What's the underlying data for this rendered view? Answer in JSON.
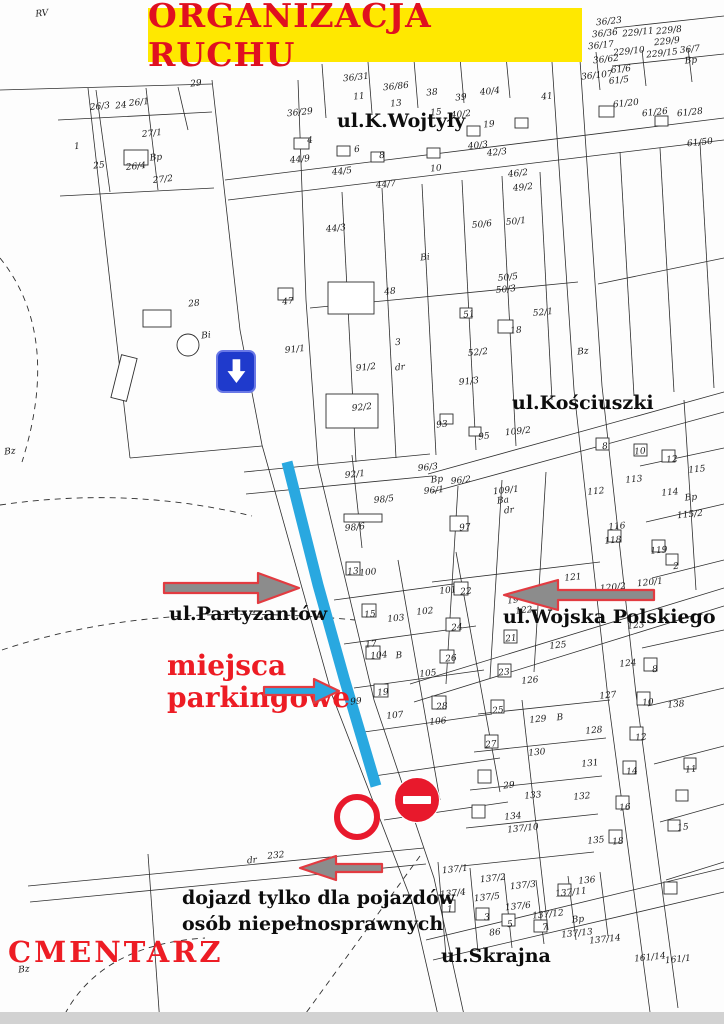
{
  "title": {
    "text": "ORGANIZACJA RUCHU"
  },
  "colors": {
    "banner-bg": "#FFE800",
    "banner-text": "#E01020",
    "annotation-red": "#ED1C24",
    "parking-blue": "#29A8E0",
    "sign-blue": "#1F3ACC",
    "prohibit-red": "#E8192C",
    "arrow-gray": "#8C8C8C",
    "arrow-outline": "#E23B41",
    "map-line": "#2E2E2E"
  },
  "streets": [
    {
      "label": "ul.K.Wojtyły"
    },
    {
      "label": "ul.Kościuszki"
    },
    {
      "label": "ul.Partyzantów"
    },
    {
      "label": "ul.Wojska Polskiego"
    },
    {
      "label": "ul.Skrajna"
    }
  ],
  "annotations": {
    "parking_line1": "miejsca",
    "parking_line2": "parkingowe",
    "cemetery": "CMENTARZ",
    "access_line1": "dojazd tylko dla pojazdów",
    "access_line2": "osób niepełnosprawnych"
  },
  "signs": [
    {
      "name": "one-way-down-sign",
      "glyph": "white-down-arrow-on-blue-square"
    },
    {
      "name": "no-entry-sign",
      "glyph": "white-bar-on-red-circle"
    },
    {
      "name": "prohibition-sign",
      "glyph": "red-circle-outline"
    }
  ],
  "arrows": [
    {
      "name": "direction-arrow-partyzantow",
      "direction": "right",
      "color": "gray"
    },
    {
      "name": "parking-direction-arrow",
      "direction": "right",
      "color": "blue"
    },
    {
      "name": "direction-arrow-wojska-polskiego",
      "direction": "left",
      "color": "gray"
    },
    {
      "name": "disabled-access-arrow",
      "direction": "left",
      "color": "gray"
    }
  ],
  "parcels": [
    {
      "t": "RV",
      "x": 42,
      "y": 14
    },
    {
      "t": "29",
      "x": 196,
      "y": 84
    },
    {
      "t": "26/3",
      "x": 100,
      "y": 107
    },
    {
      "t": "24",
      "x": 121,
      "y": 106
    },
    {
      "t": "26/1",
      "x": 139,
      "y": 103
    },
    {
      "t": "27/1",
      "x": 152,
      "y": 134
    },
    {
      "t": "1",
      "x": 77,
      "y": 147
    },
    {
      "t": "25",
      "x": 99,
      "y": 166
    },
    {
      "t": "26/4",
      "x": 136,
      "y": 167
    },
    {
      "t": "Bp",
      "x": 156,
      "y": 158
    },
    {
      "t": "27/2",
      "x": 163,
      "y": 180
    },
    {
      "t": "28",
      "x": 194,
      "y": 304
    },
    {
      "t": "Bi",
      "x": 206,
      "y": 336
    },
    {
      "t": "Bz",
      "x": 10,
      "y": 452
    },
    {
      "t": "Bz",
      "x": 24,
      "y": 970
    },
    {
      "t": "36/29",
      "x": 300,
      "y": 113
    },
    {
      "t": "4",
      "x": 310,
      "y": 141
    },
    {
      "t": "44/9",
      "x": 300,
      "y": 160
    },
    {
      "t": "6",
      "x": 357,
      "y": 150
    },
    {
      "t": "8",
      "x": 382,
      "y": 156
    },
    {
      "t": "10",
      "x": 436,
      "y": 169
    },
    {
      "t": "13",
      "x": 396,
      "y": 104
    },
    {
      "t": "11",
      "x": 359,
      "y": 97
    },
    {
      "t": "36/31",
      "x": 356,
      "y": 78
    },
    {
      "t": "36/86",
      "x": 396,
      "y": 87
    },
    {
      "t": "38",
      "x": 432,
      "y": 93
    },
    {
      "t": "39",
      "x": 461,
      "y": 98
    },
    {
      "t": "15",
      "x": 436,
      "y": 113
    },
    {
      "t": "40/4",
      "x": 490,
      "y": 92
    },
    {
      "t": "40/2",
      "x": 461,
      "y": 115
    },
    {
      "t": "19",
      "x": 489,
      "y": 125
    },
    {
      "t": "40/3",
      "x": 478,
      "y": 146
    },
    {
      "t": "42/3",
      "x": 497,
      "y": 153
    },
    {
      "t": "41",
      "x": 547,
      "y": 97
    },
    {
      "t": "44/5",
      "x": 342,
      "y": 172
    },
    {
      "t": "44/7",
      "x": 386,
      "y": 185
    },
    {
      "t": "44/3",
      "x": 336,
      "y": 229
    },
    {
      "t": "46/2",
      "x": 518,
      "y": 174
    },
    {
      "t": "49/2",
      "x": 523,
      "y": 188
    },
    {
      "t": "Bi",
      "x": 425,
      "y": 258
    },
    {
      "t": "47",
      "x": 288,
      "y": 302
    },
    {
      "t": "48",
      "x": 390,
      "y": 292
    },
    {
      "t": "3",
      "x": 398,
      "y": 343
    },
    {
      "t": "91/1",
      "x": 295,
      "y": 350
    },
    {
      "t": "50/6",
      "x": 482,
      "y": 225
    },
    {
      "t": "50/1",
      "x": 516,
      "y": 222
    },
    {
      "t": "50/5",
      "x": 508,
      "y": 278
    },
    {
      "t": "50/3",
      "x": 506,
      "y": 290
    },
    {
      "t": "51",
      "x": 469,
      "y": 315
    },
    {
      "t": "18",
      "x": 516,
      "y": 331
    },
    {
      "t": "52/1",
      "x": 543,
      "y": 313
    },
    {
      "t": "52/2",
      "x": 478,
      "y": 353
    },
    {
      "t": "91/2",
      "x": 366,
      "y": 368
    },
    {
      "t": "dr",
      "x": 400,
      "y": 368
    },
    {
      "t": "91/3",
      "x": 469,
      "y": 382
    },
    {
      "t": "92/2",
      "x": 362,
      "y": 408
    },
    {
      "t": "93",
      "x": 442,
      "y": 425
    },
    {
      "t": "95",
      "x": 484,
      "y": 437
    },
    {
      "t": "96/3",
      "x": 428,
      "y": 468
    },
    {
      "t": "Bp",
      "x": 437,
      "y": 480
    },
    {
      "t": "96/2",
      "x": 461,
      "y": 481
    },
    {
      "t": "96/1",
      "x": 434,
      "y": 491
    },
    {
      "t": "92/1",
      "x": 355,
      "y": 475
    },
    {
      "t": "98/5",
      "x": 384,
      "y": 500
    },
    {
      "t": "98/6",
      "x": 355,
      "y": 528
    },
    {
      "t": "97",
      "x": 465,
      "y": 528
    },
    {
      "t": "109/1",
      "x": 506,
      "y": 491
    },
    {
      "t": "Ba",
      "x": 503,
      "y": 501
    },
    {
      "t": "dr",
      "x": 509,
      "y": 511
    },
    {
      "t": "109/2",
      "x": 518,
      "y": 432
    },
    {
      "t": "Bz",
      "x": 583,
      "y": 352
    },
    {
      "t": "36/23",
      "x": 609,
      "y": 22
    },
    {
      "t": "36/36",
      "x": 605,
      "y": 34
    },
    {
      "t": "36/17",
      "x": 601,
      "y": 46
    },
    {
      "t": "36/62",
      "x": 606,
      "y": 60
    },
    {
      "t": "36/107",
      "x": 597,
      "y": 76
    },
    {
      "t": "229/11",
      "x": 638,
      "y": 33
    },
    {
      "t": "229/8",
      "x": 669,
      "y": 31
    },
    {
      "t": "229/9",
      "x": 667,
      "y": 42
    },
    {
      "t": "229/10",
      "x": 629,
      "y": 52
    },
    {
      "t": "229/15",
      "x": 662,
      "y": 54
    },
    {
      "t": "36/7",
      "x": 690,
      "y": 50
    },
    {
      "t": "Bp",
      "x": 691,
      "y": 61
    },
    {
      "t": "61/6",
      "x": 621,
      "y": 70
    },
    {
      "t": "61/5",
      "x": 619,
      "y": 81
    },
    {
      "t": "61/20",
      "x": 626,
      "y": 104
    },
    {
      "t": "61/26",
      "x": 655,
      "y": 113
    },
    {
      "t": "61/28",
      "x": 690,
      "y": 113
    },
    {
      "t": "61/50",
      "x": 700,
      "y": 143
    },
    {
      "t": "8",
      "x": 605,
      "y": 447
    },
    {
      "t": "10",
      "x": 640,
      "y": 452
    },
    {
      "t": "12",
      "x": 672,
      "y": 460
    },
    {
      "t": "112",
      "x": 596,
      "y": 492
    },
    {
      "t": "113",
      "x": 634,
      "y": 480
    },
    {
      "t": "114",
      "x": 670,
      "y": 493
    },
    {
      "t": "115",
      "x": 697,
      "y": 470
    },
    {
      "t": "Bp",
      "x": 691,
      "y": 498
    },
    {
      "t": "115/2",
      "x": 690,
      "y": 515
    },
    {
      "t": "116",
      "x": 617,
      "y": 527
    },
    {
      "t": "118",
      "x": 613,
      "y": 541
    },
    {
      "t": "119",
      "x": 659,
      "y": 551
    },
    {
      "t": "2",
      "x": 676,
      "y": 567
    },
    {
      "t": "120/1",
      "x": 650,
      "y": 583
    },
    {
      "t": "120/2",
      "x": 613,
      "y": 588
    },
    {
      "t": "121",
      "x": 573,
      "y": 578
    },
    {
      "t": "122",
      "x": 524,
      "y": 611
    },
    {
      "t": "19",
      "x": 513,
      "y": 601
    },
    {
      "t": "123",
      "x": 636,
      "y": 626
    },
    {
      "t": "124",
      "x": 628,
      "y": 664
    },
    {
      "t": "125",
      "x": 558,
      "y": 646
    },
    {
      "t": "21",
      "x": 511,
      "y": 639
    },
    {
      "t": "126",
      "x": 530,
      "y": 681
    },
    {
      "t": "23",
      "x": 504,
      "y": 673
    },
    {
      "t": "127",
      "x": 608,
      "y": 696
    },
    {
      "t": "129",
      "x": 538,
      "y": 720
    },
    {
      "t": "25",
      "x": 498,
      "y": 711
    },
    {
      "t": "B",
      "x": 560,
      "y": 718
    },
    {
      "t": "128",
      "x": 594,
      "y": 731
    },
    {
      "t": "130",
      "x": 537,
      "y": 753
    },
    {
      "t": "27",
      "x": 491,
      "y": 745
    },
    {
      "t": "131",
      "x": 590,
      "y": 764
    },
    {
      "t": "133",
      "x": 533,
      "y": 796
    },
    {
      "t": "29",
      "x": 509,
      "y": 786
    },
    {
      "t": "132",
      "x": 582,
      "y": 797
    },
    {
      "t": "134",
      "x": 513,
      "y": 817
    },
    {
      "t": "137/10",
      "x": 523,
      "y": 829
    },
    {
      "t": "135",
      "x": 596,
      "y": 841
    },
    {
      "t": "138",
      "x": 676,
      "y": 705
    },
    {
      "t": "8",
      "x": 655,
      "y": 670
    },
    {
      "t": "10",
      "x": 648,
      "y": 703
    },
    {
      "t": "12",
      "x": 641,
      "y": 738
    },
    {
      "t": "14",
      "x": 632,
      "y": 772
    },
    {
      "t": "16",
      "x": 625,
      "y": 808
    },
    {
      "t": "18",
      "x": 618,
      "y": 842
    },
    {
      "t": "11",
      "x": 691,
      "y": 770
    },
    {
      "t": "15",
      "x": 683,
      "y": 828
    },
    {
      "t": "100",
      "x": 368,
      "y": 573
    },
    {
      "t": "13",
      "x": 353,
      "y": 572
    },
    {
      "t": "101",
      "x": 448,
      "y": 591
    },
    {
      "t": "22",
      "x": 466,
      "y": 592
    },
    {
      "t": "103",
      "x": 396,
      "y": 619
    },
    {
      "t": "15",
      "x": 370,
      "y": 615
    },
    {
      "t": "102",
      "x": 425,
      "y": 612
    },
    {
      "t": "24",
      "x": 457,
      "y": 628
    },
    {
      "t": "104",
      "x": 379,
      "y": 656
    },
    {
      "t": "17",
      "x": 371,
      "y": 645
    },
    {
      "t": "B",
      "x": 399,
      "y": 656
    },
    {
      "t": "105",
      "x": 428,
      "y": 674
    },
    {
      "t": "26",
      "x": 451,
      "y": 659
    },
    {
      "t": "99",
      "x": 356,
      "y": 702
    },
    {
      "t": "107",
      "x": 395,
      "y": 716
    },
    {
      "t": "19",
      "x": 383,
      "y": 693
    },
    {
      "t": "106",
      "x": 438,
      "y": 722
    },
    {
      "t": "28",
      "x": 442,
      "y": 707
    },
    {
      "t": "dr",
      "x": 252,
      "y": 861
    },
    {
      "t": "232",
      "x": 276,
      "y": 856
    },
    {
      "t": "137/1",
      "x": 455,
      "y": 870
    },
    {
      "t": "137/2",
      "x": 493,
      "y": 879
    },
    {
      "t": "137/3",
      "x": 523,
      "y": 886
    },
    {
      "t": "137/4",
      "x": 453,
      "y": 894
    },
    {
      "t": "137/5",
      "x": 487,
      "y": 898
    },
    {
      "t": "137/6",
      "x": 518,
      "y": 907
    },
    {
      "t": "136",
      "x": 587,
      "y": 881
    },
    {
      "t": "137/11",
      "x": 571,
      "y": 893
    },
    {
      "t": "137/12",
      "x": 548,
      "y": 915
    },
    {
      "t": "Bp",
      "x": 578,
      "y": 920
    },
    {
      "t": "137/13",
      "x": 577,
      "y": 934
    },
    {
      "t": "137/14",
      "x": 605,
      "y": 940
    },
    {
      "t": "86",
      "x": 495,
      "y": 933
    },
    {
      "t": "1",
      "x": 450,
      "y": 910
    },
    {
      "t": "3",
      "x": 487,
      "y": 918
    },
    {
      "t": "5",
      "x": 510,
      "y": 925
    },
    {
      "t": "7",
      "x": 545,
      "y": 928
    },
    {
      "t": "161/14",
      "x": 650,
      "y": 958
    },
    {
      "t": "161/1",
      "x": 678,
      "y": 960
    }
  ]
}
